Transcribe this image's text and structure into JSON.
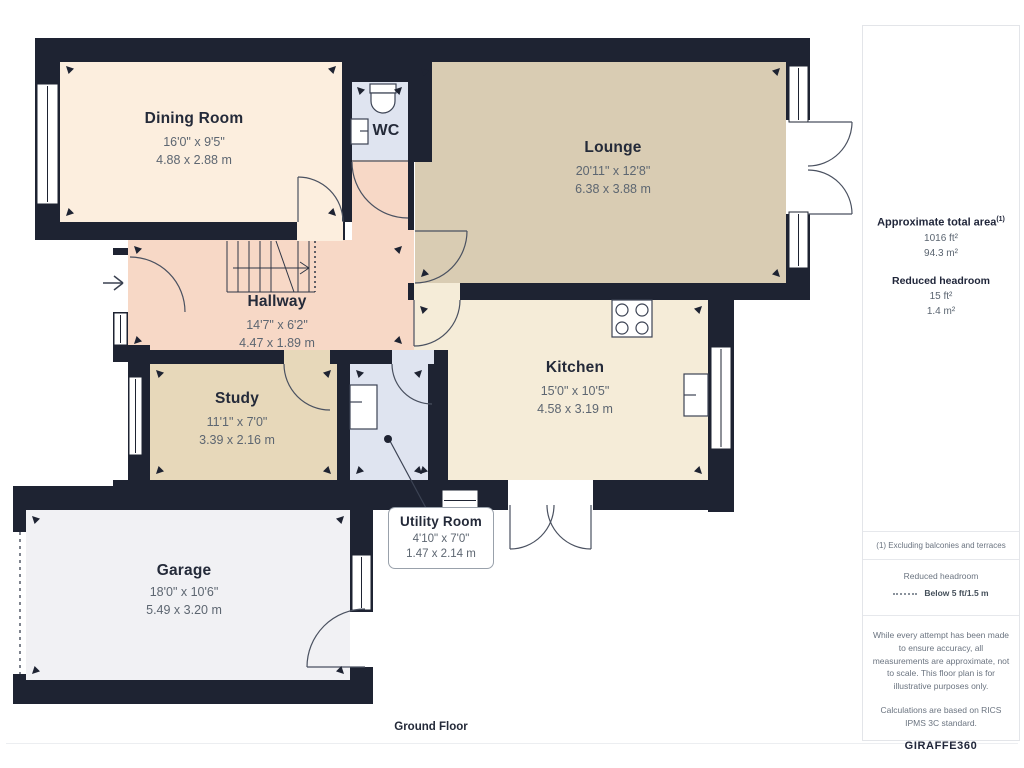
{
  "floor_label": "Ground Floor",
  "rooms": [
    {
      "name": "Dining Room",
      "imperial": "16'0\" x 9'5\"",
      "metric": "4.88 x 2.88 m"
    },
    {
      "name": "WC",
      "imperial": "",
      "metric": ""
    },
    {
      "name": "Lounge",
      "imperial": "20'11\" x 12'8\"",
      "metric": "6.38 x 3.88 m"
    },
    {
      "name": "Hallway",
      "imperial": "14'7\" x 6'2\"",
      "metric": "4.47 x 1.89 m"
    },
    {
      "name": "Study",
      "imperial": "11'1\" x 7'0\"",
      "metric": "3.39 x 2.16 m"
    },
    {
      "name": "Kitchen",
      "imperial": "15'0\" x 10'5\"",
      "metric": "4.58 x 3.19 m"
    },
    {
      "name": "Utility Room",
      "imperial": "4'10\" x 7'0\"",
      "metric": "1.47 x 2.14 m"
    },
    {
      "name": "Garage",
      "imperial": "18'0\" x 10'6\"",
      "metric": "5.49 x 3.20 m"
    }
  ],
  "sidebar": {
    "area_title": "Approximate total area",
    "area_sup": "(1)",
    "area_ft": "1016 ft²",
    "area_m": "94.3 m²",
    "rh_title": "Reduced headroom",
    "rh_ft": "15 ft²",
    "rh_m": "1.4 m²",
    "note": "(1) Excluding balconies and terraces",
    "legend_title": "Reduced headroom",
    "legend_value": "Below 5 ft/1.5 m",
    "disclaimer1": "While every attempt has been made to ensure accuracy, all measurements are approximate, not to scale. This floor plan is for illustrative purposes only.",
    "disclaimer2": "Calculations are based on RICS IPMS 3C standard.",
    "logo_giraffe": "GIRAFFE",
    "logo_360": "360"
  },
  "colors": {
    "wall": "#1e2332",
    "dining": "#fceede",
    "lounge": "#d9ccb3",
    "hallway": "#f7d8c6",
    "study": "#e7d8ba",
    "kitchen": "#f5ecd8",
    "wet": "#dfe4f0",
    "garage": "#f1f1f4"
  }
}
